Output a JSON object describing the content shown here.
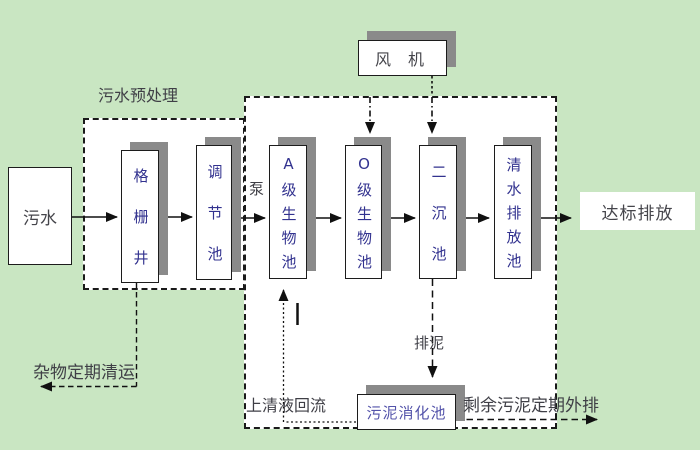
{
  "diagram_title": "污水处理工艺流程图",
  "colors": {
    "background": "#c9e6c2",
    "box_fill": "#ffffff",
    "box_border": "#1c1c1c",
    "box_shadow": "#8a8a8a",
    "tank_text": "#32328f",
    "label_text": "#3f3f46",
    "digester_text": "#5353aa",
    "line": "#111111"
  },
  "zones": {
    "pretreatment_label": "污水预处理"
  },
  "nodes": {
    "influent": "污水",
    "fan": "风 机",
    "effluent": "达标排放",
    "digester": "污泥消化池"
  },
  "tanks": [
    {
      "id": "grid-well",
      "label": "格栅井"
    },
    {
      "id": "regulating-tank",
      "label": "调节池"
    },
    {
      "id": "a-bio-tank",
      "label": "A级生物池"
    },
    {
      "id": "o-bio-tank",
      "label": "O级生物池"
    },
    {
      "id": "secondary-clarifier",
      "label": "二沉池"
    },
    {
      "id": "clean-water-discharge-tank",
      "label": "清水排放池"
    }
  ],
  "flow_labels": {
    "pump": "泵",
    "debris_removal": "杂物定期清运",
    "supernatant_return": "上清液回流",
    "sludge_discharge": "排泥",
    "excess_sludge_out": "剩余污泥定期外排"
  }
}
